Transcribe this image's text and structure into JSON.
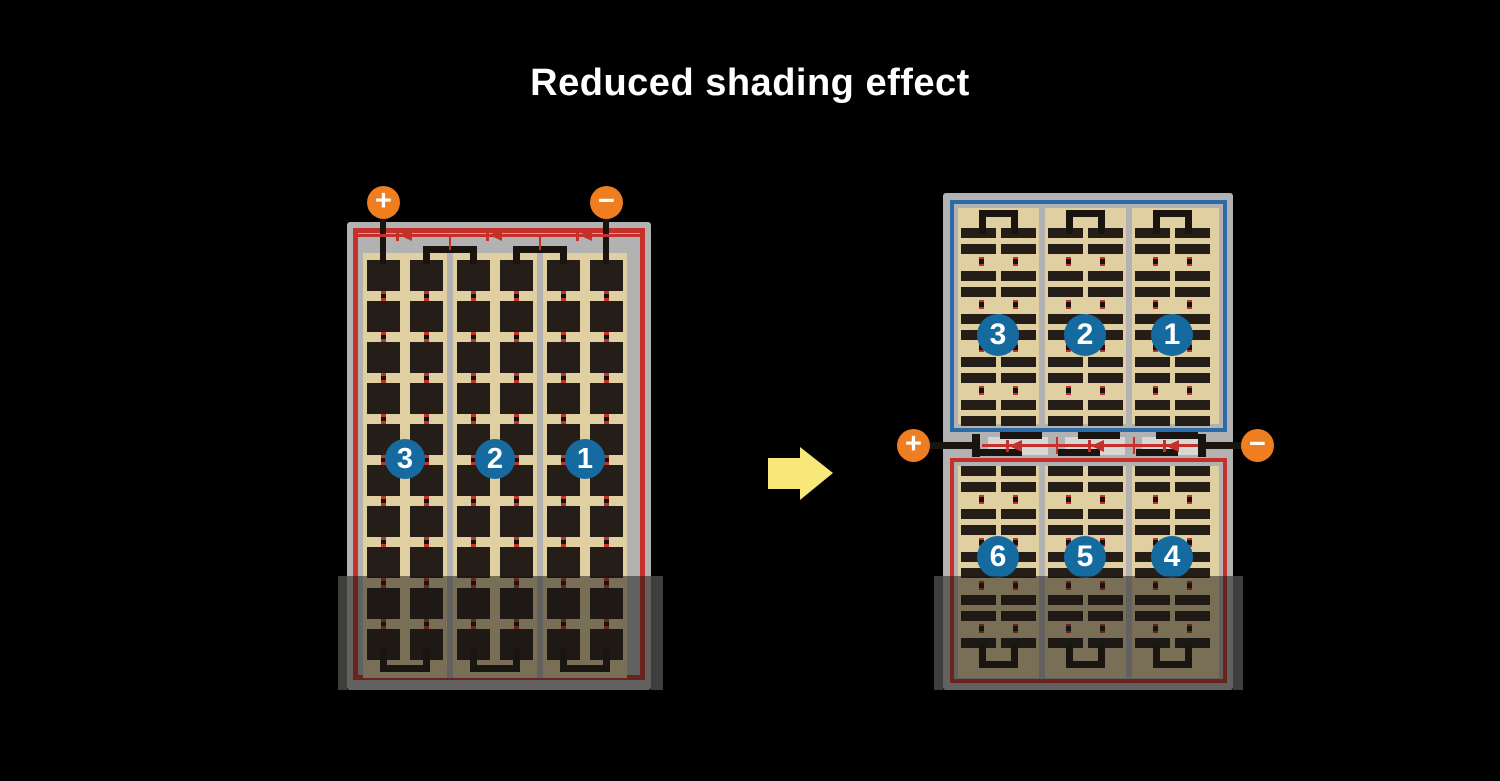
{
  "title": "Reduced shading effect",
  "arrow": {
    "icon": "right-arrow",
    "color": "#f8e87a"
  },
  "colors": {
    "background": "#000000",
    "panel_frame": "#b2b2b2",
    "cell_area_tan": "#e0cfa0",
    "cell_dark": "#251d18",
    "red_circuit": "#c5302a",
    "blue_circuit": "#2c6ba3",
    "terminal_orange": "#ee7e20",
    "string_badge_blue": "#156a9f",
    "shade_overlay": "rgba(25,23,20,0.52)"
  },
  "left_panel": {
    "terminals": {
      "positive": "+",
      "negative": "−"
    },
    "strings": [
      {
        "label": "3"
      },
      {
        "label": "2"
      },
      {
        "label": "1"
      }
    ]
  },
  "right_panel": {
    "terminals": {
      "positive": "+",
      "negative": "−"
    },
    "top_strings": [
      {
        "label": "3"
      },
      {
        "label": "2"
      },
      {
        "label": "1"
      }
    ],
    "bottom_strings": [
      {
        "label": "6"
      },
      {
        "label": "5"
      },
      {
        "label": "4"
      }
    ]
  }
}
